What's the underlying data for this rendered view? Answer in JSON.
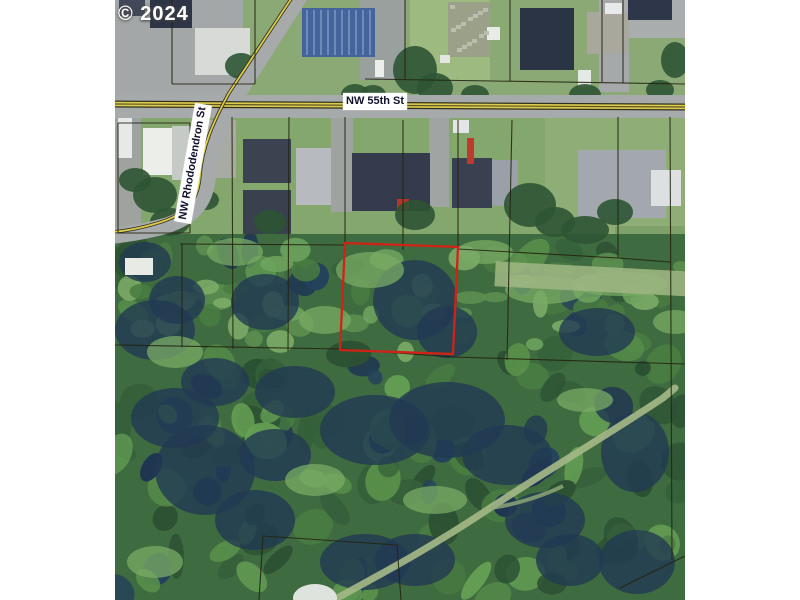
{
  "watermark": {
    "text": "© 2024"
  },
  "map": {
    "type": "aerial-parcel-map",
    "streets": [
      {
        "name": "NW 55th St"
      },
      {
        "name": "NW Rhododendron St"
      }
    ],
    "highlighted_parcel": {
      "outline_color": "#d02318"
    },
    "colors": {
      "parcel_line": "#23230f",
      "road_centerline_yellow": "#ddcb4e",
      "road_casing": "#32321c",
      "pavement": "#a6aaab",
      "lawn": "#85a871",
      "forest": "#3f6b40",
      "page_background": "#ffffff"
    }
  }
}
